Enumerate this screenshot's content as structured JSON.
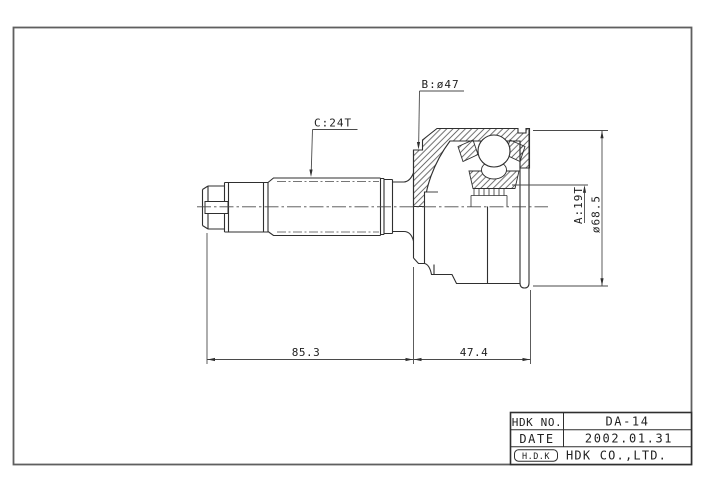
{
  "drawing": {
    "labels": {
      "b": "B:ø47",
      "c": "C:24T",
      "a": "A:19T",
      "od": "ø68.5"
    },
    "dimensions": {
      "shaft_length": "85.3",
      "housing_length": "47.4"
    }
  },
  "title_block": {
    "part_no_label": "HDK NO.",
    "part_no": "DA-14",
    "date_label": "DATE",
    "date": "2002.01.31",
    "logo": "H.D.K",
    "company": "HDK CO.,LTD."
  },
  "colors": {
    "line": "#2f2f2f",
    "thin_line": "#4a4a4a",
    "frame": "#5f5f5f",
    "background": "#ffffff"
  }
}
